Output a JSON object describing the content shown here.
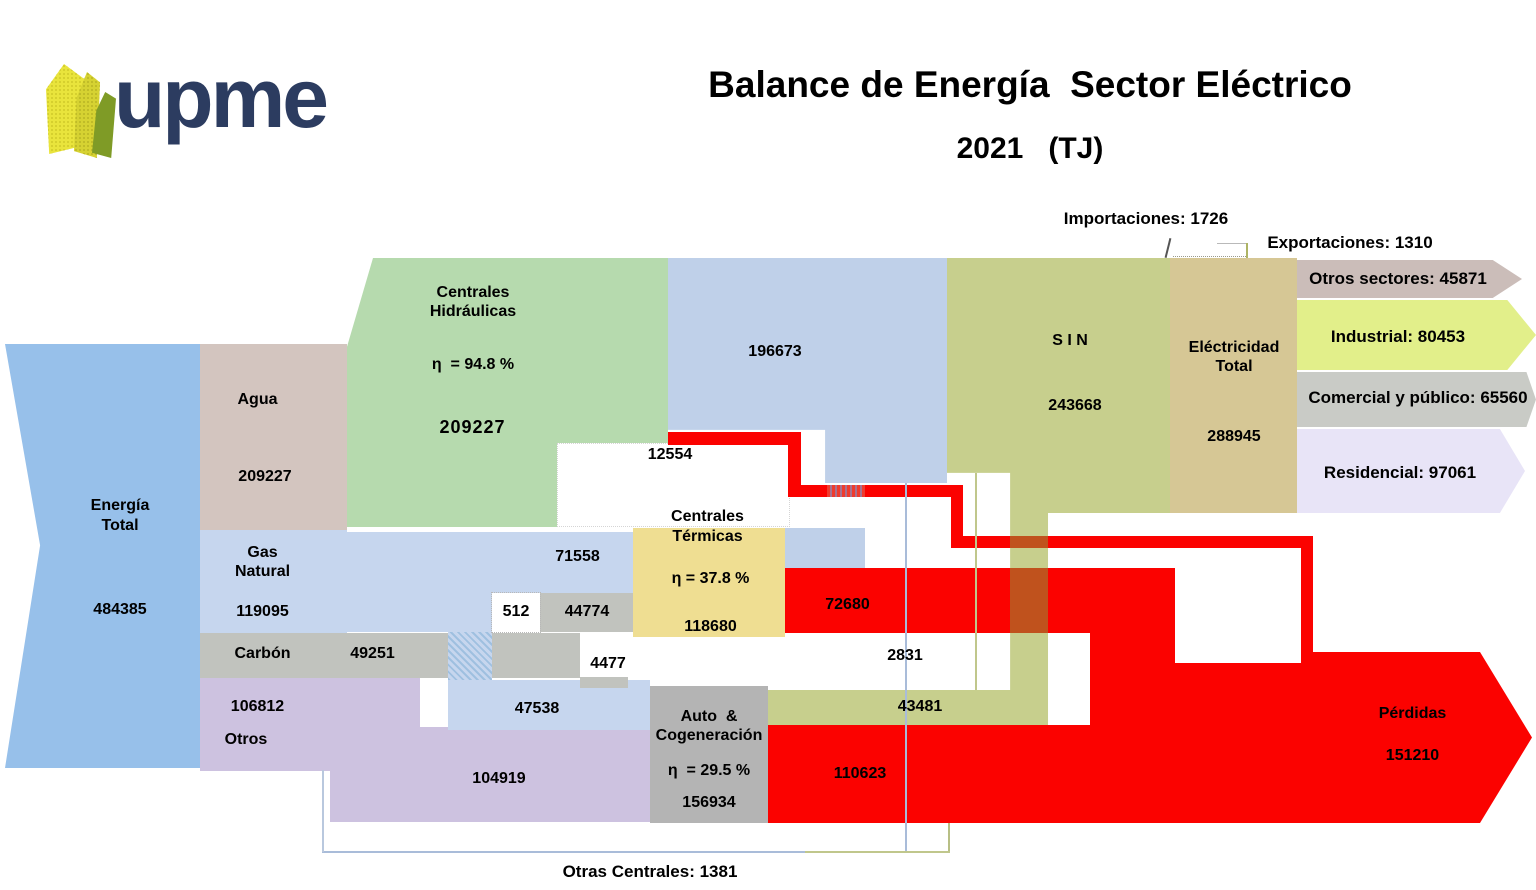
{
  "header": {
    "logo_text": "upme",
    "title": "Balance de Energía  Sector Eléctrico",
    "subtitle": "2021   (TJ)"
  },
  "annotations": {
    "importaciones": "Importaciones: 1726",
    "exportaciones": "Exportaciones: 1310",
    "otras_centrales": "Otras Centrales: 1381"
  },
  "nodes": {
    "energia_total": {
      "l1": "Energía",
      "l2": "Total",
      "value": "484385"
    },
    "agua": {
      "label": "Agua",
      "value": "209227"
    },
    "hidraulicas": {
      "l1": "Centrales",
      "l2": "Hidráulicas",
      "eff": "η  = 94.8 %",
      "value": "209227"
    },
    "gas_natural": {
      "l1": "Gas",
      "l2": "Natural",
      "value": "119095"
    },
    "carbon": {
      "label": "Carbón",
      "value": "49251"
    },
    "otros": {
      "label": "Otros",
      "value": "106812"
    },
    "termicas": {
      "l1": "Centrales",
      "l2": "Térmicas",
      "eff": "η = 37.8 %",
      "value": "118680"
    },
    "auto_cog": {
      "l1": "Auto  &",
      "l2": "Cogeneración",
      "eff": "η  = 29.5 %",
      "value": "156934"
    },
    "sin": {
      "label": "S I N",
      "value": "243668"
    },
    "electricidad": {
      "l1": "Eléctricidad",
      "l2": "Total",
      "value": "288945"
    },
    "perdidas": {
      "label": "Pérdidas",
      "value": "151210"
    },
    "otros_sectores": {
      "label": "Otros sectores: 45871"
    },
    "industrial": {
      "label": "Industrial: 80453"
    },
    "comercial": {
      "label": "Comercial y público: 65560"
    },
    "residencial": {
      "label": "Residencial: 97061"
    }
  },
  "flows": {
    "hidro_sin": "196673",
    "hidro_perdidas": "12554",
    "gn_termicas": "71558",
    "gn_otras": "512",
    "carbon_termicas": "44774",
    "carbon_auto": "4477",
    "gn_auto": "47538",
    "termicas_perdidas": "72680",
    "termicas_elec": "2831",
    "auto_sin": "43481",
    "auto_perdidas": "110623",
    "otros_auto": "104919"
  },
  "colors": {
    "energia_blue": "#97c0ea",
    "agua_taupe": "#d3c5bf",
    "hidraulicas_green": "#b6daae",
    "flow_blue": "#bfd0e9",
    "gas_blue": "#c6d6ee",
    "sin_olive": "#c7cf8d",
    "electricidad_tan": "#d6c795",
    "otros_sectores_mauve": "#cbbdb9",
    "industrial_yellowgreen": "#e2ef8a",
    "comercial_gray": "#c9cbc6",
    "residencial_lavender": "#e8e4f7",
    "carbon_gray": "#c1c3be",
    "otros_purple": "#cdc2e0",
    "auto_gray": "#b4b4b4",
    "termicas_yellow": "#efde92",
    "losses_red": "#fb0200",
    "red_olive_overlap": "#c0521d",
    "logo_navy": "#2c3c60",
    "logo_yellow": "#e9e43c",
    "logo_green": "#7f9b26"
  },
  "chart_data": {
    "type": "sankey",
    "title": "Balance de Energía Sector Eléctrico",
    "year": "2021",
    "unit": "TJ",
    "nodes": [
      {
        "name": "Energía Total",
        "value": 484385
      },
      {
        "name": "Agua",
        "value": 209227
      },
      {
        "name": "Gas Natural",
        "value": 119095
      },
      {
        "name": "Carbón",
        "value": 49251
      },
      {
        "name": "Otros",
        "value": 106812
      },
      {
        "name": "Centrales Hidráulicas",
        "value": 209227,
        "efficiency_pct": 94.8
      },
      {
        "name": "Centrales Térmicas",
        "value": 118680,
        "efficiency_pct": 37.8
      },
      {
        "name": "Auto & Cogeneración",
        "value": 156934,
        "efficiency_pct": 29.5
      },
      {
        "name": "S I N",
        "value": 243668
      },
      {
        "name": "Eléctricidad Total",
        "value": 288945
      },
      {
        "name": "Pérdidas",
        "value": 151210
      },
      {
        "name": "Importaciones",
        "value": 1726
      },
      {
        "name": "Exportaciones",
        "value": 1310
      },
      {
        "name": "Otras Centrales",
        "value": 1381
      },
      {
        "name": "Otros sectores",
        "value": 45871
      },
      {
        "name": "Industrial",
        "value": 80453
      },
      {
        "name": "Comercial y público",
        "value": 65560
      },
      {
        "name": "Residencial",
        "value": 97061
      }
    ],
    "links": [
      {
        "source": "Energía Total",
        "target": "Agua",
        "value": 209227
      },
      {
        "source": "Energía Total",
        "target": "Gas Natural",
        "value": 119095
      },
      {
        "source": "Energía Total",
        "target": "Carbón",
        "value": 49251
      },
      {
        "source": "Energía Total",
        "target": "Otros",
        "value": 106812
      },
      {
        "source": "Agua",
        "target": "Centrales Hidráulicas",
        "value": 209227
      },
      {
        "source": "Centrales Hidráulicas",
        "target": "S I N",
        "value": 196673
      },
      {
        "source": "Centrales Hidráulicas",
        "target": "Pérdidas",
        "value": 12554
      },
      {
        "source": "Gas Natural",
        "target": "Centrales Térmicas",
        "value": 71558
      },
      {
        "source": "Gas Natural",
        "target": "Otras Centrales",
        "value": 512
      },
      {
        "source": "Gas Natural",
        "target": "Auto & Cogeneración",
        "value": 47538
      },
      {
        "source": "Carbón",
        "target": "Centrales Térmicas",
        "value": 44774
      },
      {
        "source": "Carbón",
        "target": "Auto & Cogeneración",
        "value": 4477
      },
      {
        "source": "Otros",
        "target": "Auto & Cogeneración",
        "value": 104919
      },
      {
        "source": "Centrales Térmicas",
        "target": "Pérdidas",
        "value": 72680
      },
      {
        "source": "Centrales Térmicas",
        "target": "Eléctricidad Total",
        "value": 2831
      },
      {
        "source": "Auto & Cogeneración",
        "target": "S I N",
        "value": 43481
      },
      {
        "source": "Auto & Cogeneración",
        "target": "Pérdidas",
        "value": 110623
      },
      {
        "source": "Importaciones",
        "target": "Eléctricidad Total",
        "value": 1726
      },
      {
        "source": "Eléctricidad Total",
        "target": "Exportaciones",
        "value": 1310
      },
      {
        "source": "Otras Centrales",
        "target": "S I N",
        "value": 1381
      },
      {
        "source": "S I N",
        "target": "Eléctricidad Total",
        "value": 243668
      },
      {
        "source": "Eléctricidad Total",
        "target": "Otros sectores",
        "value": 45871
      },
      {
        "source": "Eléctricidad Total",
        "target": "Industrial",
        "value": 80453
      },
      {
        "source": "Eléctricidad Total",
        "target": "Comercial y público",
        "value": 65560
      },
      {
        "source": "Eléctricidad Total",
        "target": "Residencial",
        "value": 97061
      }
    ],
    "legend_position": "none",
    "grid": false
  }
}
